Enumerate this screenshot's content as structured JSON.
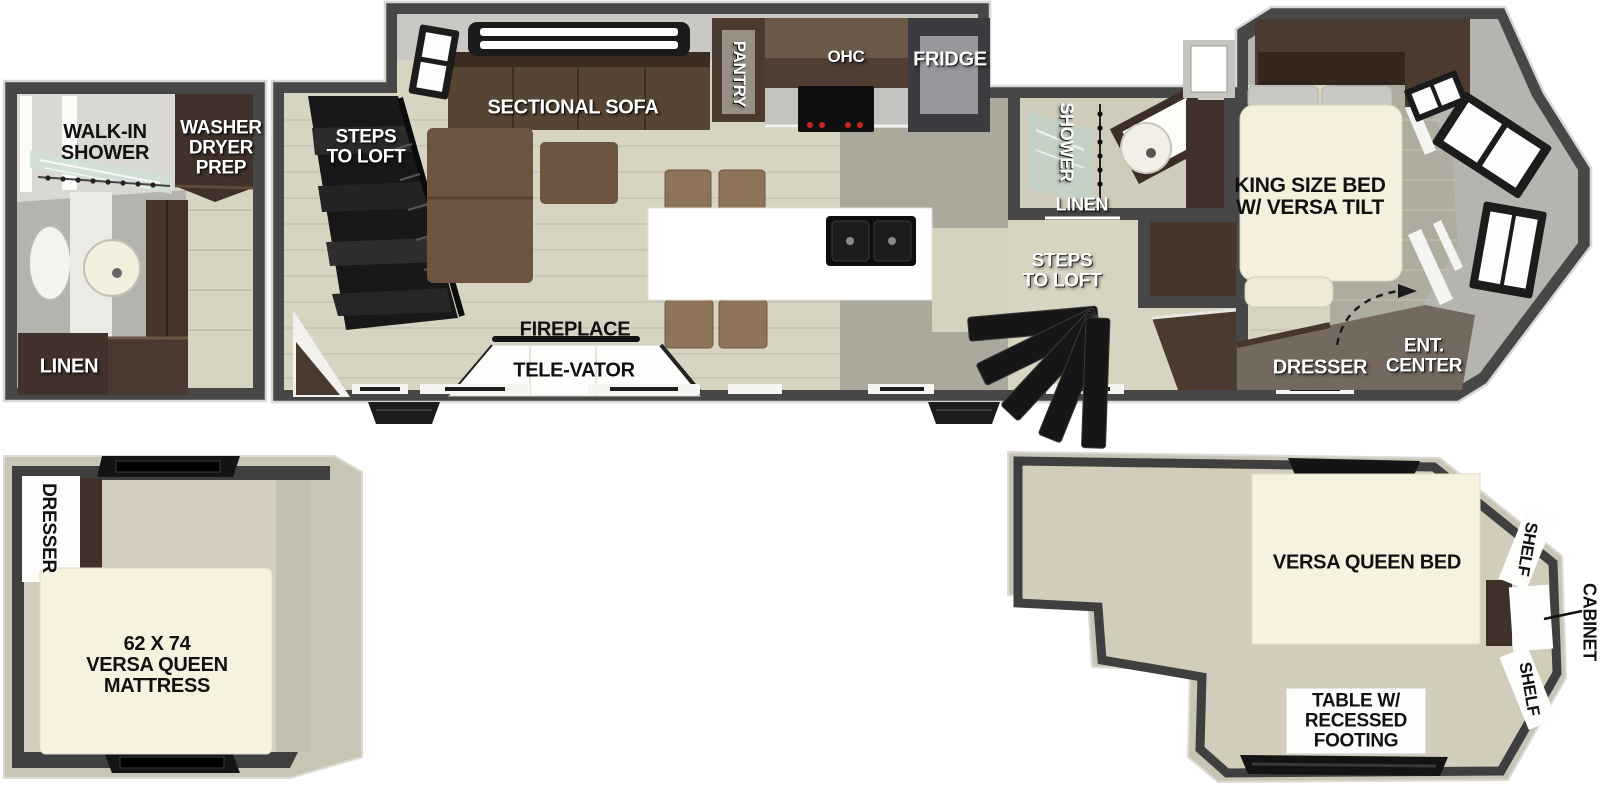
{
  "diagram_title": "RV travel trailer floor plan with loft levels",
  "colors": {
    "wall_dark": "#474747",
    "deck_beige": "#c9c5b4",
    "floor_light": "#d8d4c2",
    "floor_gray_green": "#a7a599",
    "interior_wall_gray": "#b5b4ae",
    "cabinet_dark_brown": "#40312a",
    "sofa_brown": "#5f4c3a",
    "stool_brown": "#8d7459",
    "mattress_cream": "#f6f2df",
    "island_white": "#ffffff",
    "accent_red": "#cc2222",
    "label_white": "#ffffff",
    "label_black": "#111111"
  },
  "main_floorplan": {
    "bathroom": {
      "walk_in_shower": "WALK-IN\nSHOWER",
      "washer_dryer_prep": "WASHER\nDRYER\nPREP",
      "linen": "LINEN"
    },
    "living": {
      "steps_to_loft": "STEPS\nTO LOFT",
      "sectional_sofa": "SECTIONAL SOFA",
      "fireplace": "FIREPLACE",
      "tele_vator": "TELE-VATOR"
    },
    "kitchen": {
      "pantry": "PANTRY",
      "ohc": "OHC",
      "fridge": "FRIDGE"
    },
    "mid_bath": {
      "shower": "SHOWER",
      "linen": "LINEN",
      "steps_to_loft": "STEPS\nTO LOFT"
    },
    "bedroom": {
      "king_bed": "KING SIZE BED\nW/ VERSA TILT",
      "dresser": "DRESSER",
      "ent_center": "ENT.\nCENTER"
    }
  },
  "loft_front": {
    "dresser": "DRESSER",
    "mattress": "62 X 74\nVERSA QUEEN\nMATTRESS"
  },
  "loft_rear": {
    "bed": "VERSA QUEEN BED",
    "shelf_top": "SHELF",
    "cabinet": "CABINET",
    "shelf_bottom": "SHELF",
    "table": "TABLE W/\nRECESSED\nFOOTING"
  }
}
